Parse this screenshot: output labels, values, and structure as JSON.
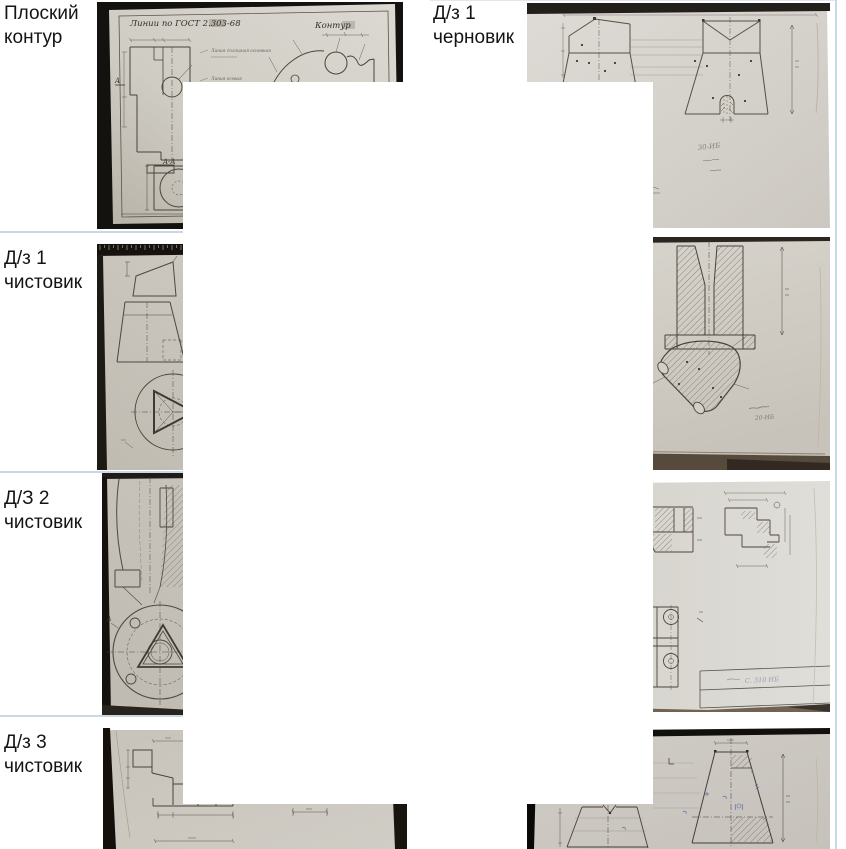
{
  "colors": {
    "separator": "#ccd7e6",
    "page_bg": "#ffffff"
  },
  "rows": [
    {
      "left_label": "Плоский контур",
      "right_label": "Д/з 1 черновик"
    },
    {
      "left_label": "Д/з 1 чистовик"
    },
    {
      "left_label": "Д/З 2 чистовик"
    },
    {
      "left_label": "Д/з 3 чистовик"
    }
  ],
  "drawing_texts": {
    "gost_title": "Линии по ГОСТ 2.303-68",
    "kontur_label": "Контур",
    "section_label": "A-A",
    "view_arrow_label": "A",
    "note1": "Линия сплошная основная",
    "note2": "Линия осевая",
    "hw_draft1": "30-ИБ",
    "hw_clean1": "20-ИБ",
    "hw_clean2": "С. 310 ИБ"
  }
}
